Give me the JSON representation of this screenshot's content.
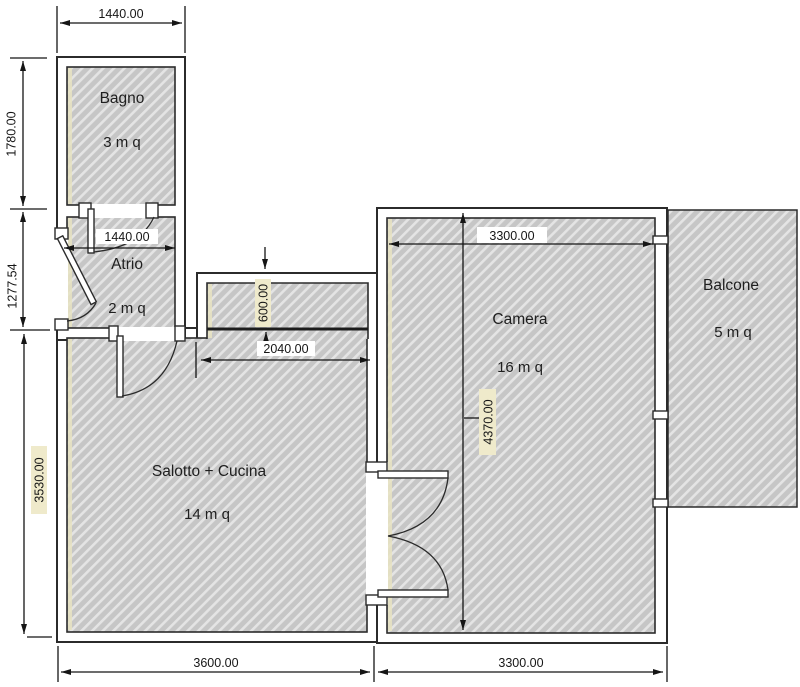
{
  "title": "Apartment floor plan",
  "rooms": {
    "bagno": {
      "name": "Bagno",
      "area": "3 m q"
    },
    "atrio": {
      "name": "Atrio",
      "area": "2 m q"
    },
    "salotto": {
      "name": "Salotto + Cucina",
      "area": "14 m q"
    },
    "camera": {
      "name": "Camera",
      "area": "16 m q"
    },
    "balcone": {
      "name": "Balcone",
      "area": "5 m q"
    }
  },
  "dims": {
    "bagno_width": "1440.00",
    "bagno_height": "1780.00",
    "atrio_height": "1277.54",
    "salotto_height": "3530.00",
    "salotto_width": "3600.00",
    "camera_width_bottom": "3300.00",
    "camera_width_top": "3300.00",
    "camera_height": "4370.00",
    "atrio_inner_width": "1440.00",
    "niche_depth": "600.00",
    "niche_width": "2040.00"
  },
  "colors": {
    "wall_line": "#2b2b2b",
    "hatch_base": "#c6c6c6",
    "hatch_stripe": "#e4e4e4",
    "dim_line": "#151515",
    "accent_yellow": "#e7e3c2",
    "label_bg_yellow": "#efeacb",
    "background": "#ffffff"
  }
}
